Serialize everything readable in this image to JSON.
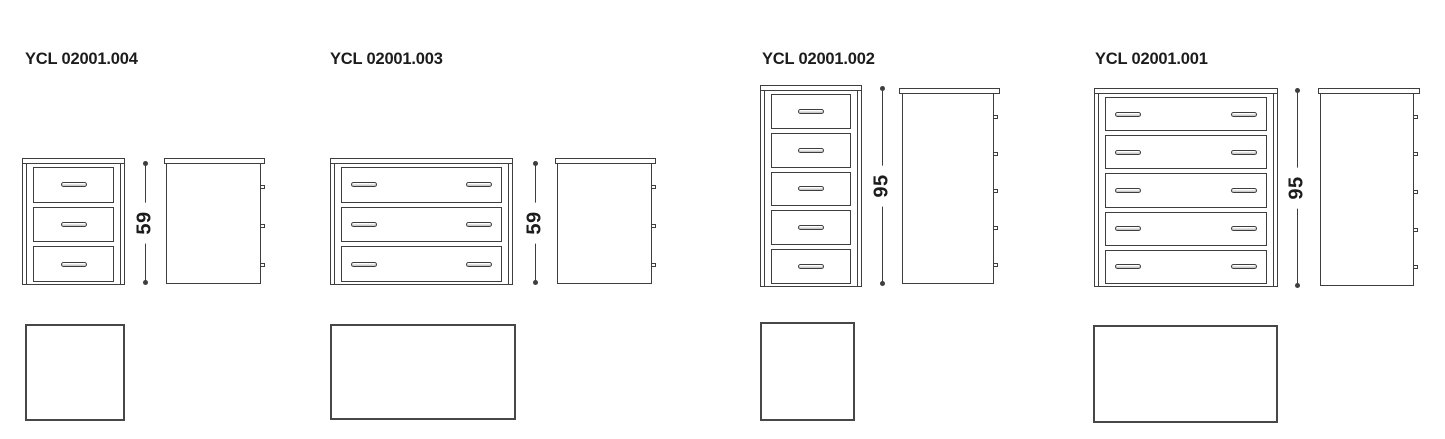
{
  "sheet": {
    "background": "#ffffff",
    "line_color": "#3e3e3e",
    "text_color": "#1c1c1c"
  },
  "products": [
    {
      "code": "YCL 02001.004",
      "height_label": "59",
      "drawers": 3,
      "handles_per_drawer": 1
    },
    {
      "code": "YCL 02001.003",
      "height_label": "59",
      "drawers": 3,
      "handles_per_drawer": 2
    },
    {
      "code": "YCL 02001.002",
      "height_label": "95",
      "drawers": 5,
      "handles_per_drawer": 1
    },
    {
      "code": "YCL 02001.001",
      "height_label": "95",
      "drawers": 5,
      "handles_per_drawer": 2
    }
  ]
}
